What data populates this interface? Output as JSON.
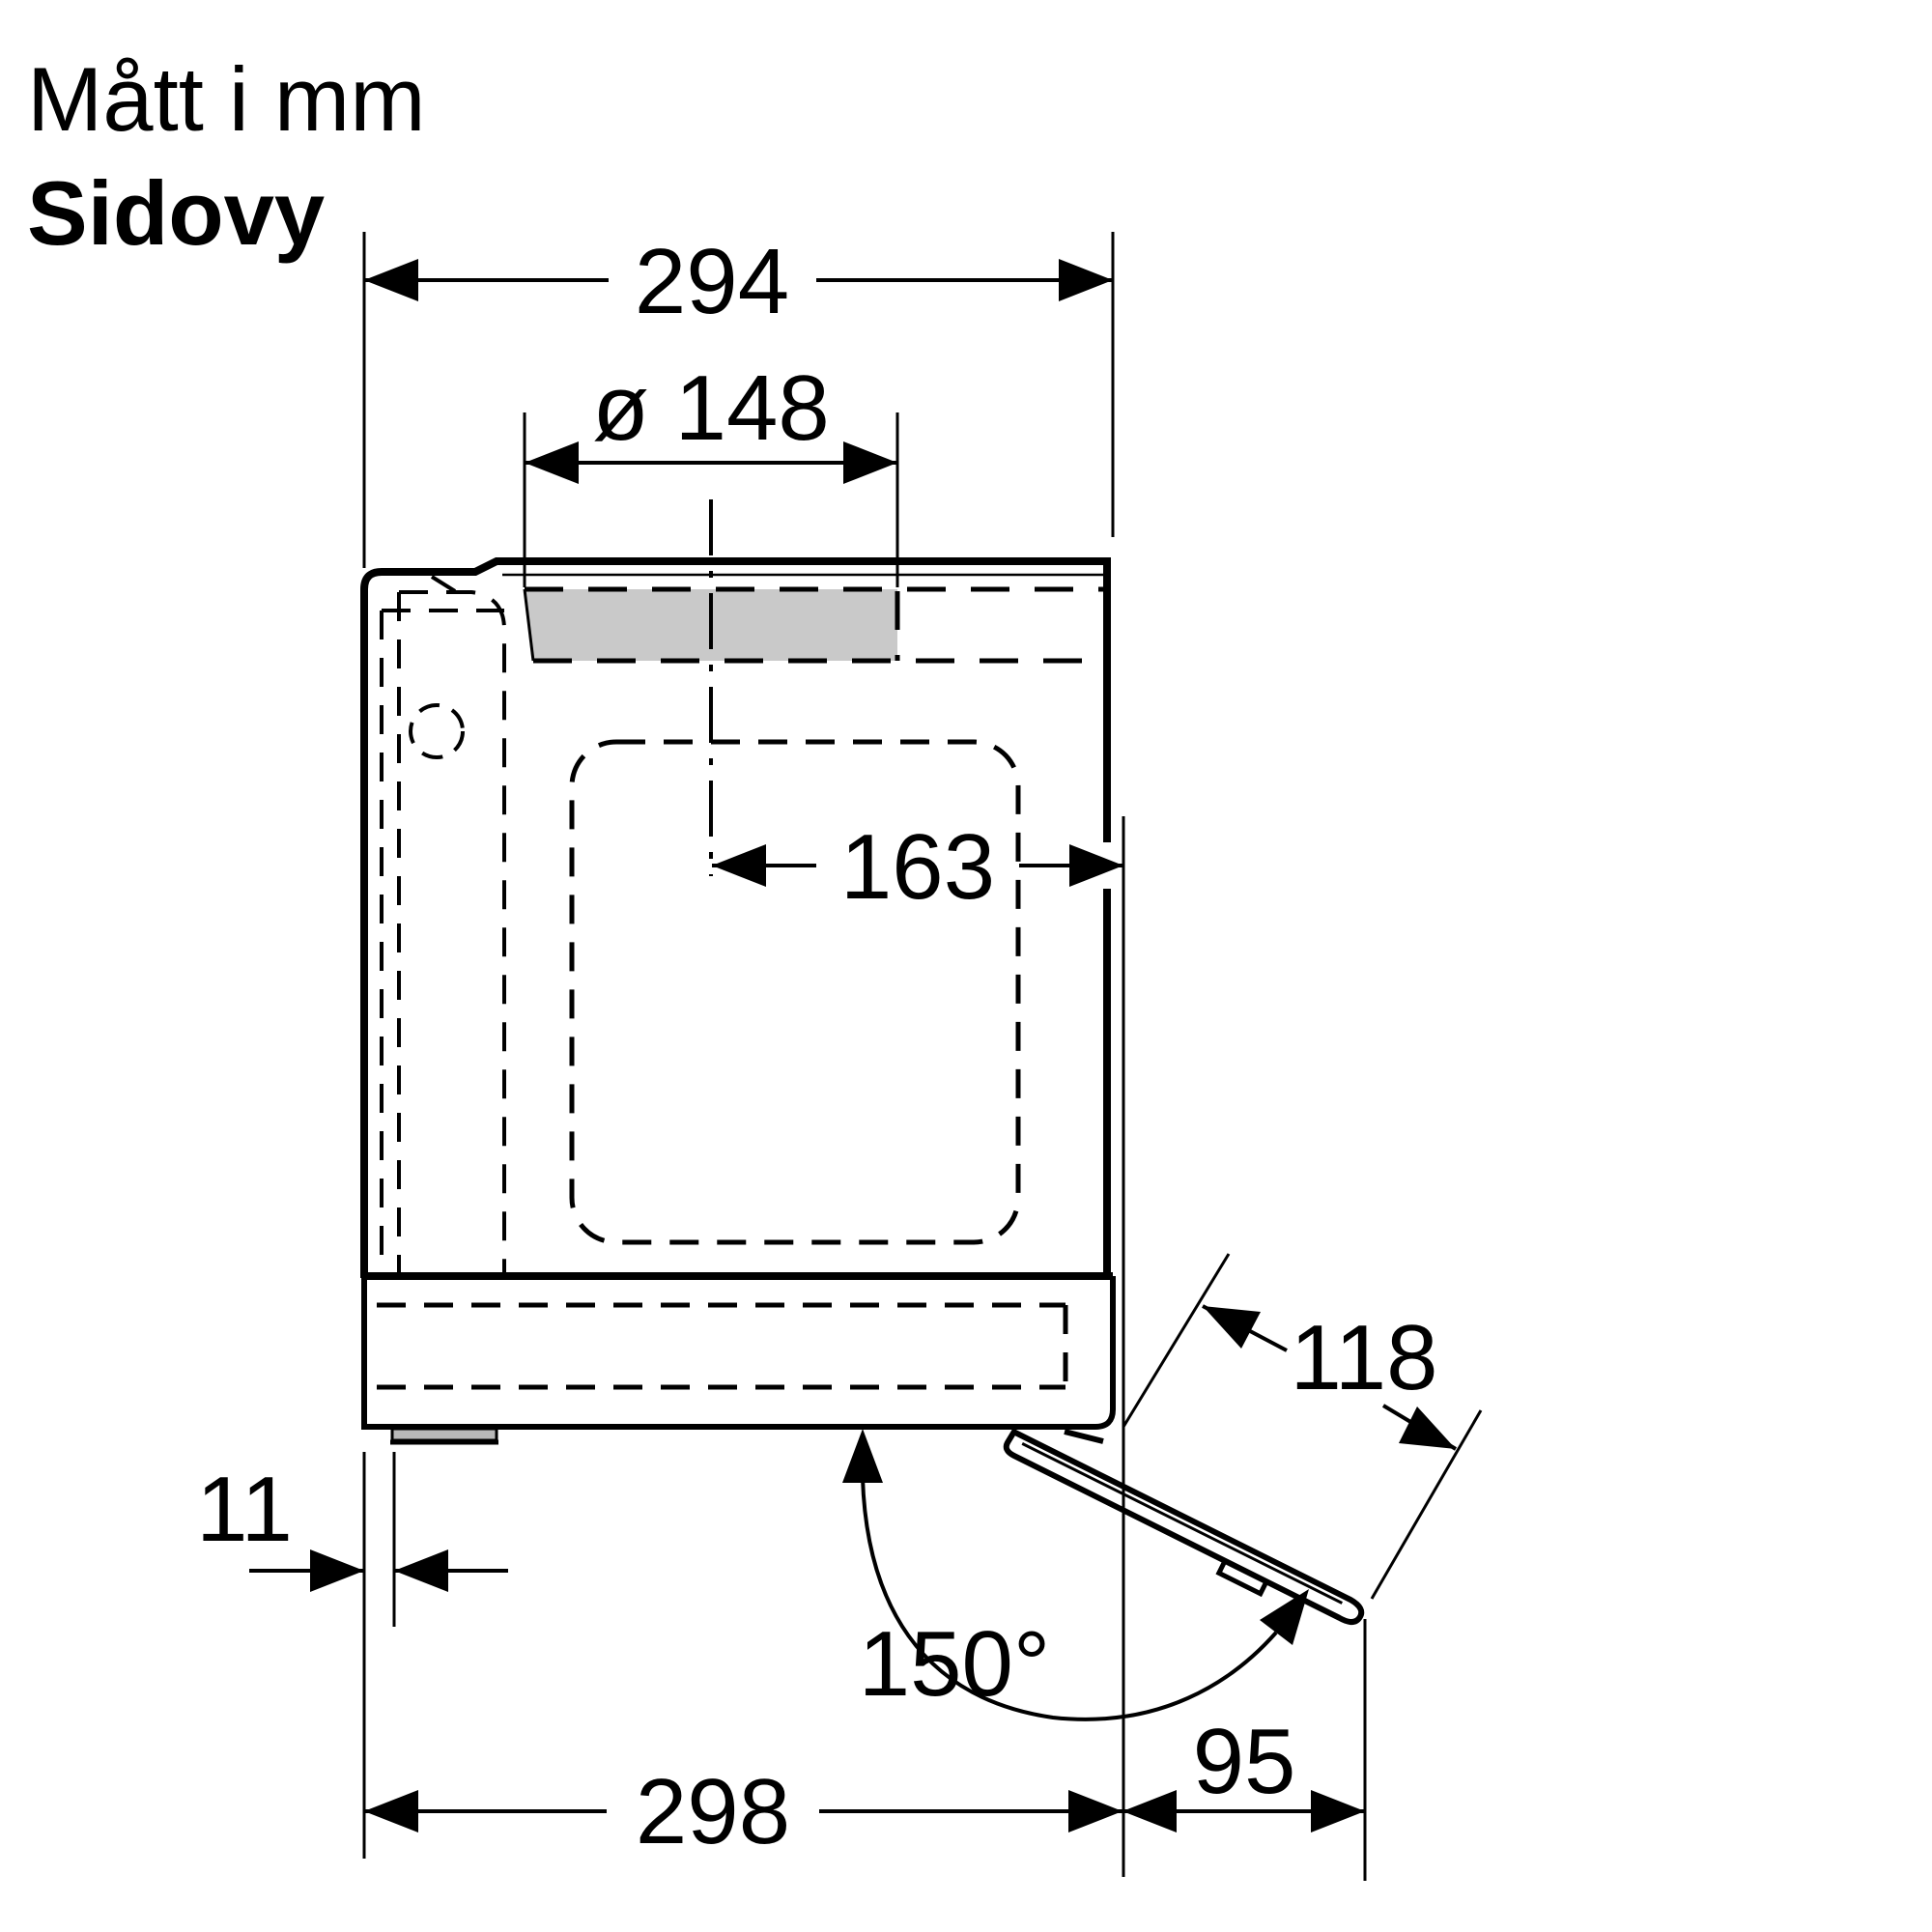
{
  "title": {
    "line1": "Mått i mm",
    "line2": "Sidovy"
  },
  "dims": {
    "top_width": "294",
    "hole_diameter": "ø 148",
    "hole_center_to_front": "163",
    "foot_inset": "11",
    "door_open_angle": "150°",
    "door_length": "118",
    "bottom_depth": "298",
    "door_projection": "95"
  },
  "colors": {
    "line": "#000000",
    "hole_fill": "#c9c9c9",
    "foot_fill": "#b9b9b9",
    "background": "#ffffff"
  }
}
